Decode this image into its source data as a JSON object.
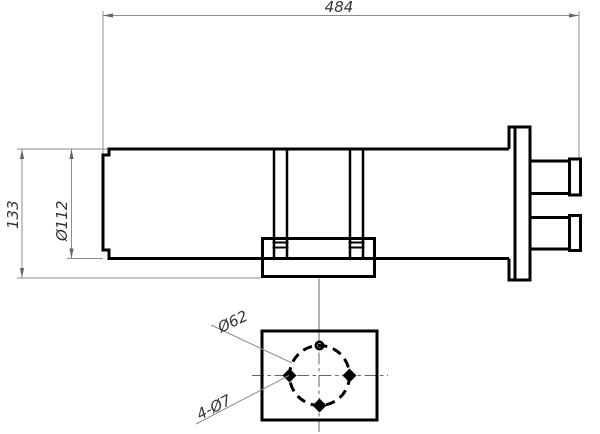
{
  "drawing": {
    "type": "engineering-drawing",
    "description": "Cylindrical assembly side view with end flange, two connector stubs, mounting bracket, and bottom view of mounting plate with bolt circle",
    "dimensions": {
      "overall_length": "484",
      "overall_height": "133",
      "body_diameter": "Ø112",
      "bolt_circle": "Ø62",
      "holes": "4-Ø7"
    }
  },
  "colors": {
    "bg": "#ffffff",
    "outline": "#000000",
    "dim": "#8c8c8c",
    "center": "#666666",
    "label": "#333333"
  }
}
